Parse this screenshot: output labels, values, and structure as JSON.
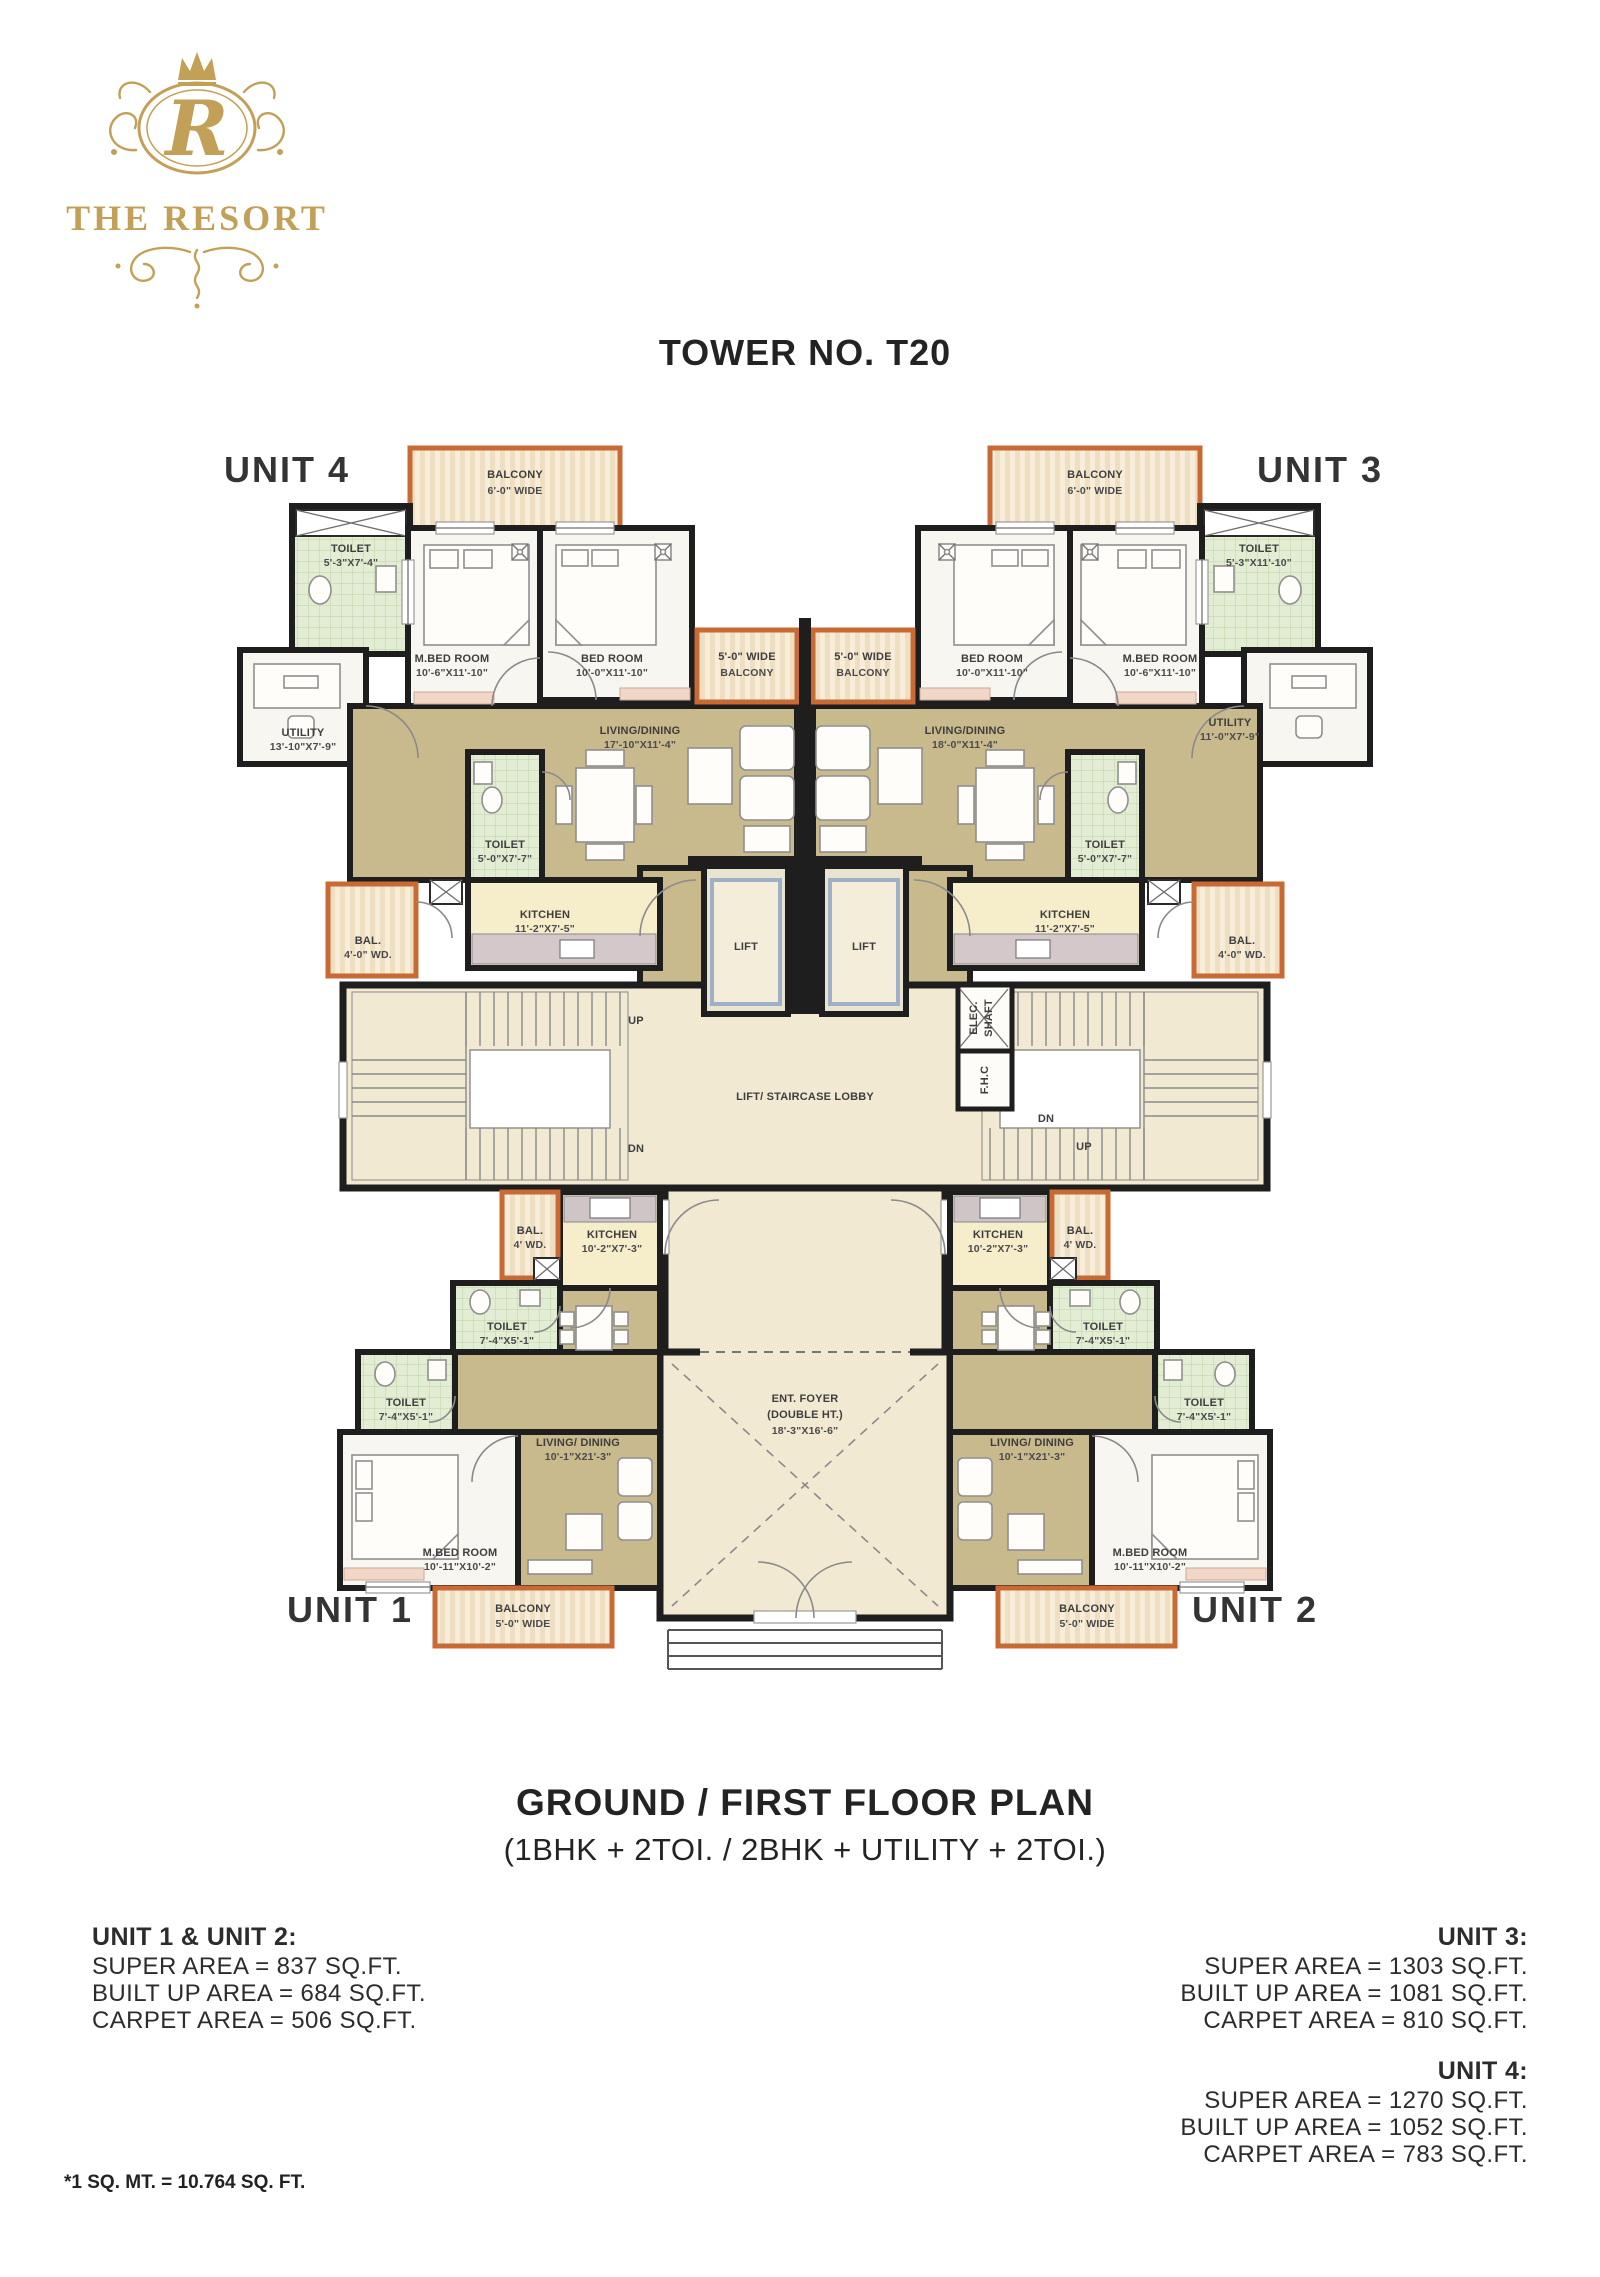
{
  "logo": {
    "monogram": "R",
    "name": "THE RESORT"
  },
  "title": "TOWER NO. T20",
  "units": {
    "u1": "UNIT 1",
    "u2": "UNIT 2",
    "u3": "UNIT 3",
    "u4": "UNIT 4"
  },
  "plan": {
    "u4": {
      "balcony": {
        "l1": "BALCONY",
        "l2": "6'-0\" WIDE"
      },
      "toilet_top": {
        "l1": "TOILET",
        "l2": "5'-3\"X7'-4\""
      },
      "mbed": {
        "l1": "M.BED ROOM",
        "l2": "10'-6\"X11'-10\""
      },
      "bed": {
        "l1": "BED ROOM",
        "l2": "10'-0\"X11'-10\""
      },
      "utility": {
        "l1": "UTILITY",
        "l2": "13'-10\"X7'-9\""
      },
      "side_balcony": {
        "l1": "5'-0\" WIDE",
        "l2": "BALCONY"
      },
      "living": {
        "l1": "LIVING/DINING",
        "l2": "17'-10\"X11'-4\""
      },
      "toilet": {
        "l1": "TOILET",
        "l2": "5'-0\"X7'-7\""
      },
      "kitchen": {
        "l1": "KITCHEN",
        "l2": "11'-2\"X7'-5\""
      },
      "bal": {
        "l1": "BAL.",
        "l2": "4'-0\" WD."
      }
    },
    "u3": {
      "balcony": {
        "l1": "BALCONY",
        "l2": "6'-0\" WIDE"
      },
      "toilet_top": {
        "l1": "TOILET",
        "l2": "5'-3\"X11'-10\""
      },
      "mbed": {
        "l1": "M.BED ROOM",
        "l2": "10'-6\"X11'-10\""
      },
      "bed": {
        "l1": "BED ROOM",
        "l2": "10'-0\"X11'-10\""
      },
      "utility": {
        "l1": "UTILITY",
        "l2": "11'-0\"X7'-9\""
      },
      "side_balcony": {
        "l1": "5'-0\" WIDE",
        "l2": "BALCONY"
      },
      "living": {
        "l1": "LIVING/DINING",
        "l2": "18'-0\"X11'-4\""
      },
      "toilet": {
        "l1": "TOILET",
        "l2": "5'-0\"X7'-7\""
      },
      "kitchen": {
        "l1": "KITCHEN",
        "l2": "11'-2\"X7'-5\""
      },
      "bal": {
        "l1": "BAL.",
        "l2": "4'-0\" WD."
      }
    },
    "u1": {
      "kitchen": {
        "l1": "KITCHEN",
        "l2": "10'-2\"X7'-3\""
      },
      "bal": {
        "l1": "BAL.",
        "l2": "4' WD."
      },
      "toilet_a": {
        "l1": "TOILET",
        "l2": "7'-4\"X5'-1\""
      },
      "toilet_b": {
        "l1": "TOILET",
        "l2": "7'-4\"X5'-1\""
      },
      "living": {
        "l1": "LIVING/ DINING",
        "l2": "10'-1\"X21'-3\""
      },
      "mbed": {
        "l1": "M.BED ROOM",
        "l2": "10'-11\"X10'-2\""
      },
      "balcony": {
        "l1": "BALCONY",
        "l2": "5'-0\" WIDE"
      }
    },
    "u2": {
      "kitchen": {
        "l1": "KITCHEN",
        "l2": "10'-2\"X7'-3\""
      },
      "bal": {
        "l1": "BAL.",
        "l2": "4' WD."
      },
      "toilet_a": {
        "l1": "TOILET",
        "l2": "7'-4\"X5'-1\""
      },
      "toilet_b": {
        "l1": "TOILET",
        "l2": "7'-4\"X5'-1\""
      },
      "living": {
        "l1": "LIVING/ DINING",
        "l2": "10'-1\"X21'-3\""
      },
      "mbed": {
        "l1": "M.BED ROOM",
        "l2": "10'-11\"X10'-2\""
      },
      "balcony": {
        "l1": "BALCONY",
        "l2": "5'-0\" WIDE"
      }
    },
    "core": {
      "lift": "LIFT",
      "lobby": "LIFT/ STAIRCASE LOBBY",
      "up": "UP",
      "dn": "DN",
      "elec1": "ELEC.",
      "elec2": "SHAFT",
      "fhc": "F.H.C",
      "foyer1": "ENT. FOYER",
      "foyer2": "(DOUBLE HT.)",
      "foyer3": "18'-3\"X16'-6\""
    }
  },
  "footer": {
    "plan_title": "GROUND / FIRST FLOOR PLAN",
    "plan_subtitle": "(1BHK + 2TOI. / 2BHK + UTILITY + 2TOI.)",
    "stats": [
      {
        "heading": "UNIT 1 & UNIT 2:",
        "lines": [
          "SUPER AREA = 837 SQ.FT.",
          "BUILT UP AREA =  684 SQ.FT.",
          "CARPET AREA = 506 SQ.FT."
        ]
      },
      {
        "heading": "UNIT 3:",
        "lines": [
          "SUPER AREA = 1303 SQ.FT.",
          "BUILT UP AREA = 1081 SQ.FT.",
          "CARPET AREA = 810 SQ.FT."
        ]
      },
      {
        "heading": "UNIT 4:",
        "lines": [
          "SUPER AREA = 1270 SQ.FT.",
          "BUILT UP AREA = 1052 SQ.FT.",
          "CARPET AREA = 783 SQ.FT."
        ]
      }
    ],
    "footnote": "*1 SQ. MT. = 10.764 SQ. FT."
  },
  "colors": {
    "brand_gold": "#c2a057",
    "wall": "#1e1e1e",
    "living_tan": "#c8ba8d",
    "lobby_cream": "#f1e9d2",
    "toilet_green": "#e3edd4",
    "kitchen_yellow": "#f6edca",
    "balcony_cream": "#f8edd9",
    "balcony_border": "#c96a35",
    "accent_pink": "#f3d7c6"
  }
}
